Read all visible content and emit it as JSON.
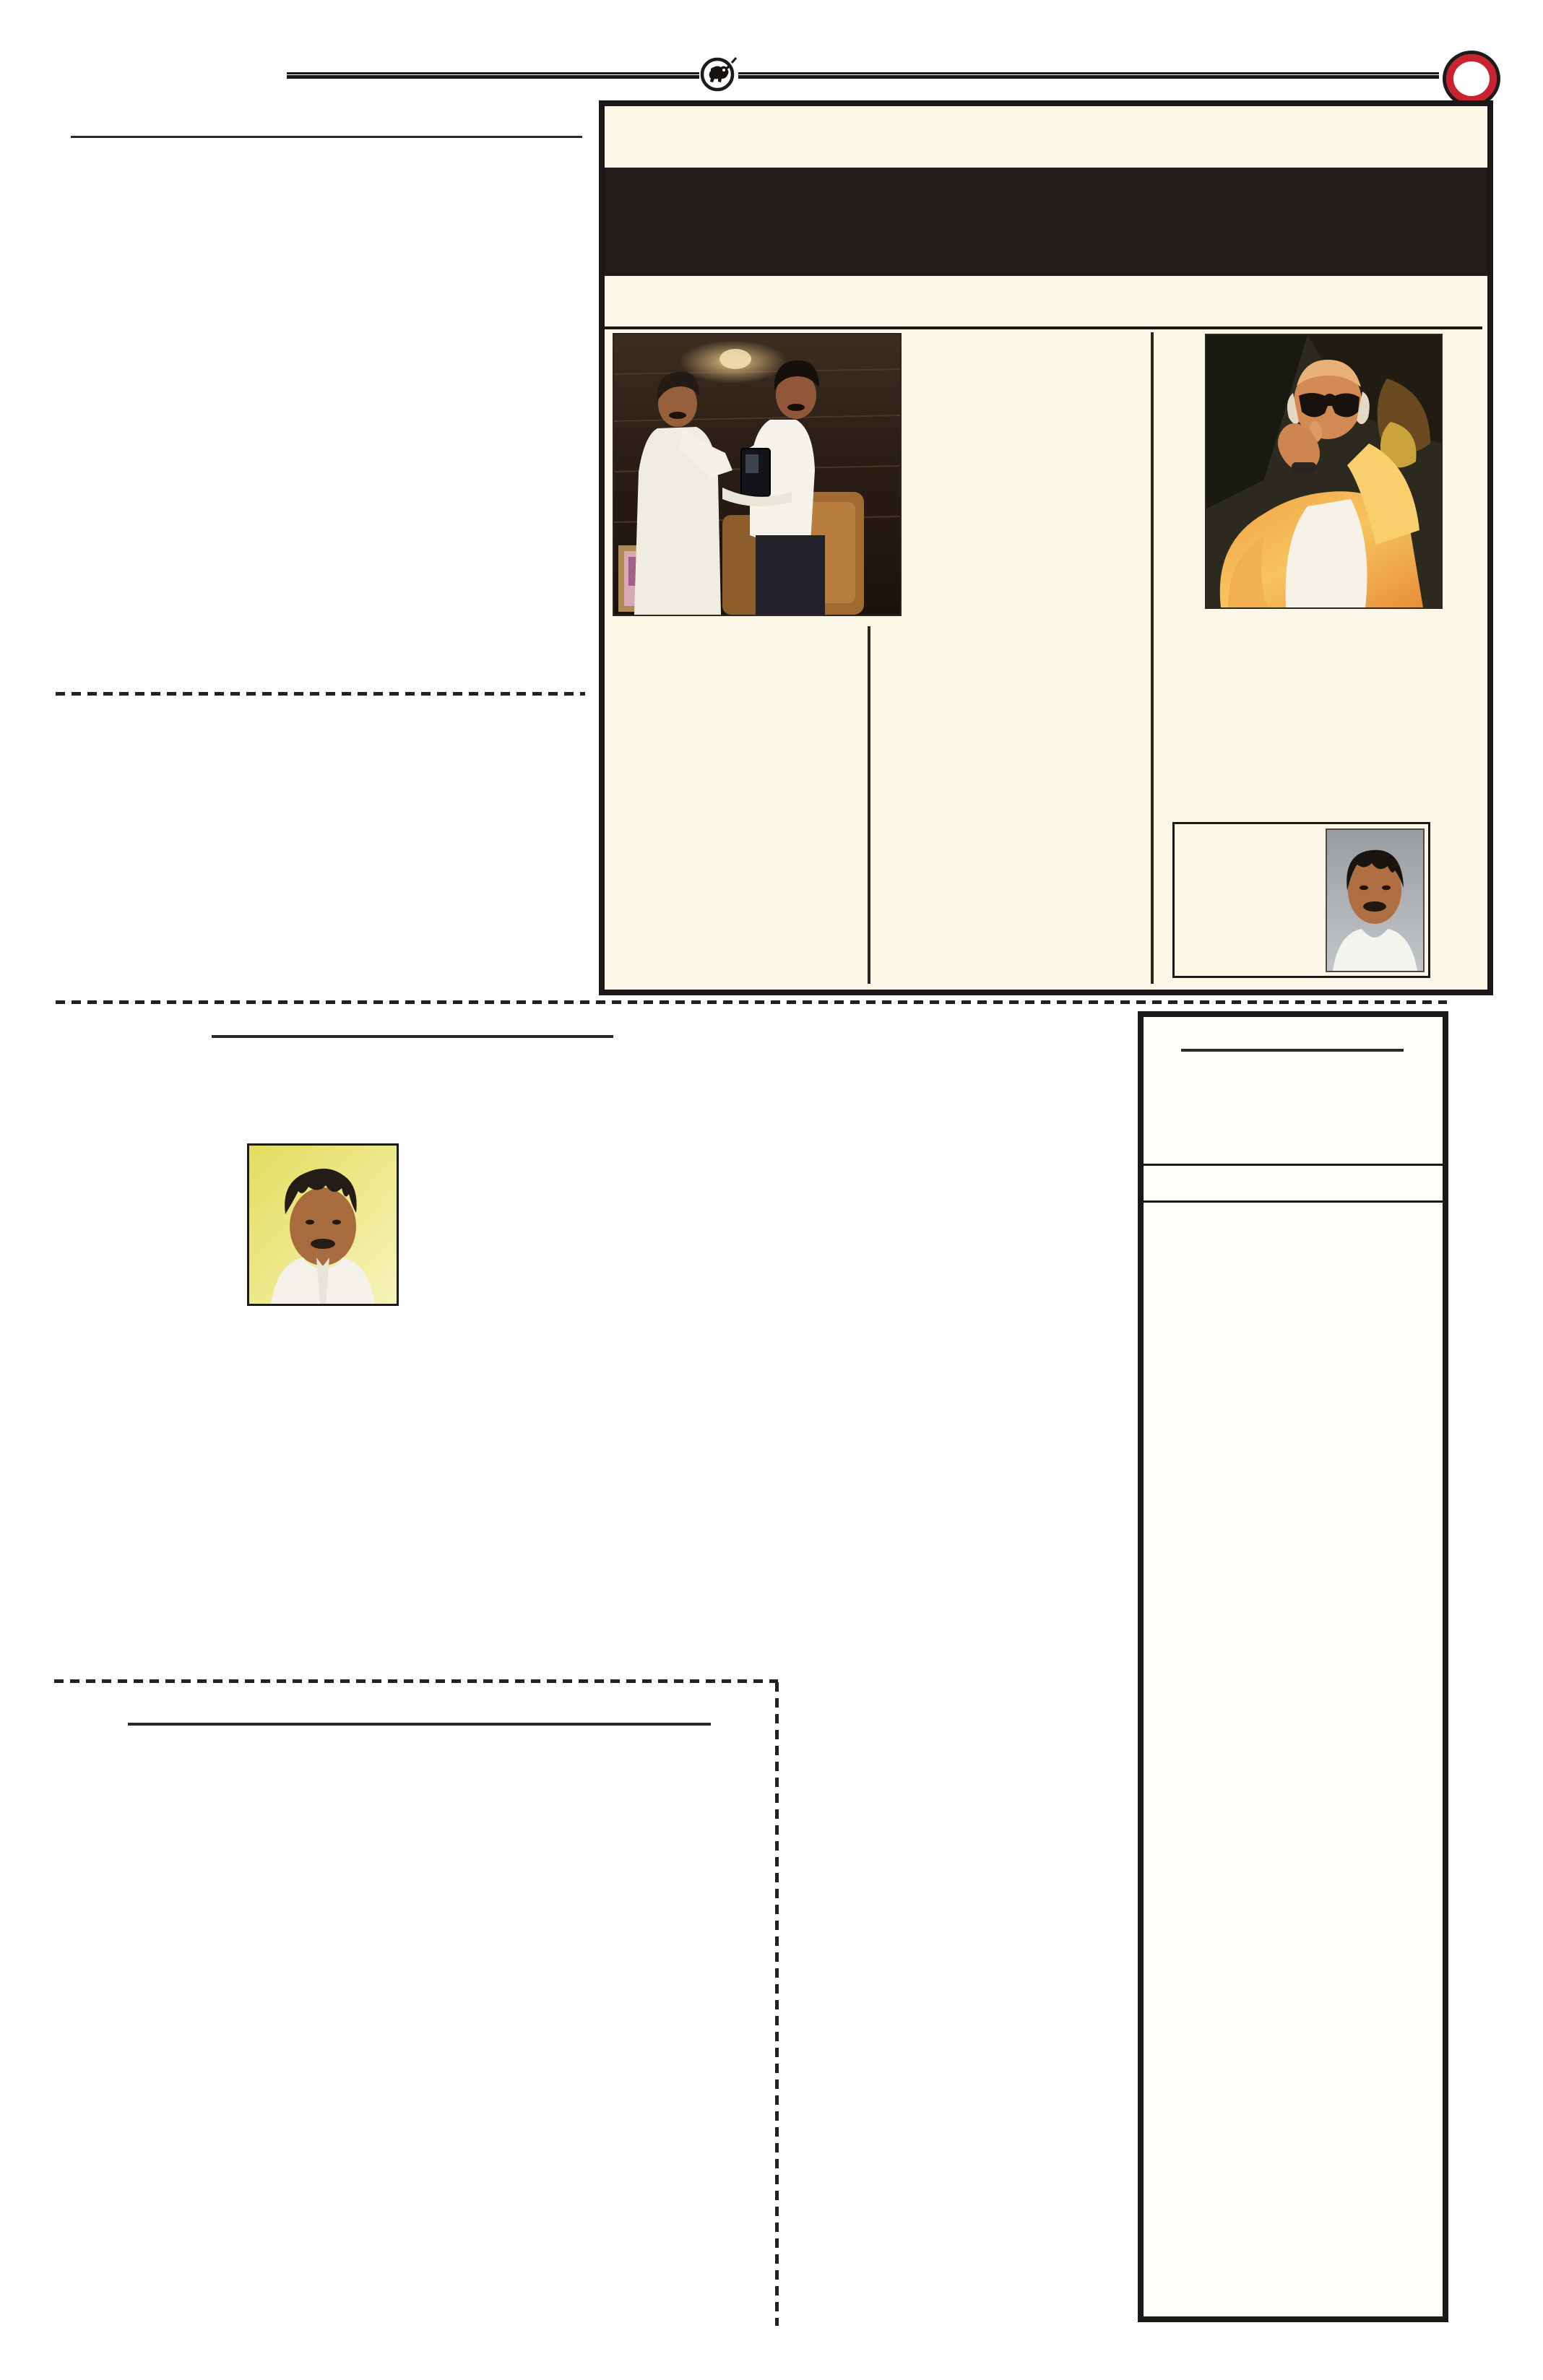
{
  "document": {
    "type": "newspaper-page-scan",
    "visible_text": "",
    "page_background": "#ffffff"
  },
  "masthead": {
    "emblem_icon": "bull-in-circle-emblem",
    "seal_icon": "red-ring-seal",
    "rule_style": "double-line"
  },
  "colors": {
    "feature_box_background": "#faf7e6",
    "feature_box_border": "#1b1918",
    "headline_banner": "#211d1b",
    "column_rule": "#2a2825",
    "headline_underline": "#2c2a28",
    "dashed_rule": "#242220",
    "seal_red": "#c8232e",
    "sidebar_box_background": "#fffef9",
    "yellow_portrait_bg": "#e6df63"
  },
  "images": [
    {
      "name": "presentation-photo",
      "desc": "two men in white handing over a dark memento, wood panel room"
    },
    {
      "name": "orange-shawl-painting",
      "desc": "painted portrait of elderly man with dark glasses and orange-yellow shawl"
    },
    {
      "name": "poet-portrait",
      "desc": "man, black hair, thick moustache, white shirt, grey backdrop"
    },
    {
      "name": "yellow-portrait",
      "desc": "man with dark curly hair and moustache, white shirt, yellow backdrop"
    }
  ]
}
